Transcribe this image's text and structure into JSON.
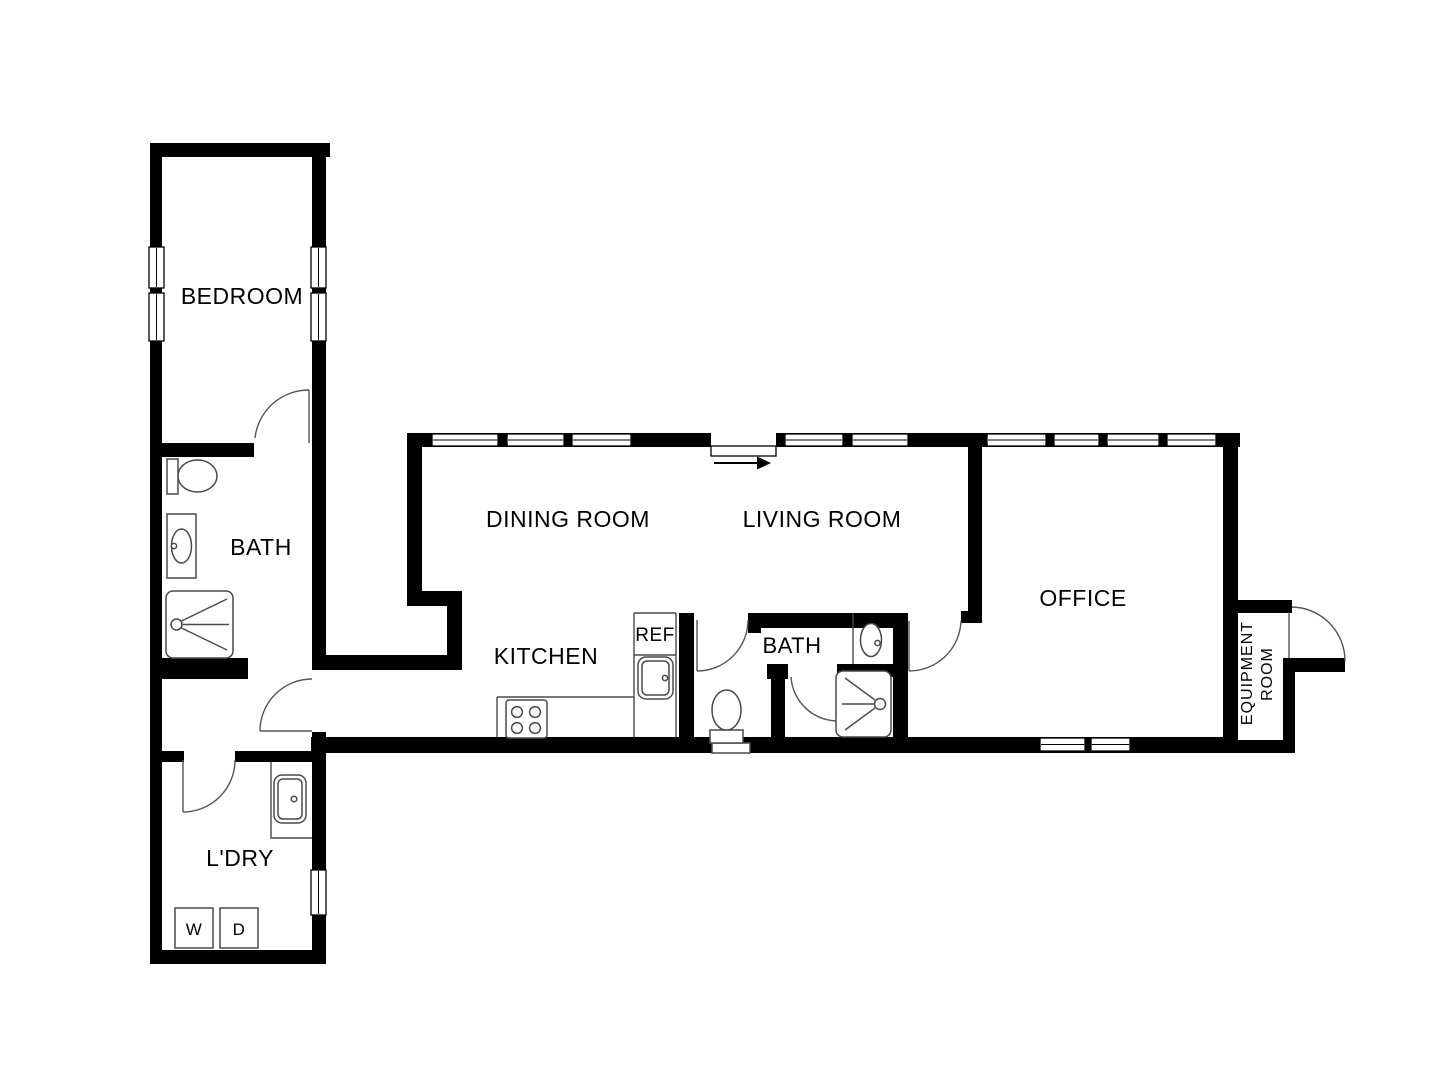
{
  "plan": {
    "background": "#ffffff",
    "wall_color": "#000000",
    "fixture_line_color": "#4a4a4a",
    "door_arc_color": "#555555",
    "rooms": {
      "bedroom": {
        "label": "BEDROOM"
      },
      "bath_left": {
        "label": "BATH"
      },
      "laundry": {
        "label": "L'DRY"
      },
      "dining_room": {
        "label": "DINING ROOM"
      },
      "living_room": {
        "label": "LIVING ROOM"
      },
      "kitchen": {
        "label": "KITCHEN"
      },
      "bath_center": {
        "label": "BATH"
      },
      "office": {
        "label": "OFFICE"
      },
      "equipment_room": {
        "label_line1": "EQUIPMENT",
        "label_line2": "ROOM"
      }
    },
    "appliances": {
      "refrigerator_label": "REF",
      "washer_label": "W",
      "dryer_label": "D"
    },
    "fixtures": [
      "toilet",
      "vanity-sink",
      "shower",
      "stove",
      "kitchen-sink",
      "refrigerator",
      "laundry-sink",
      "washer",
      "dryer",
      "entry-arrow"
    ]
  }
}
